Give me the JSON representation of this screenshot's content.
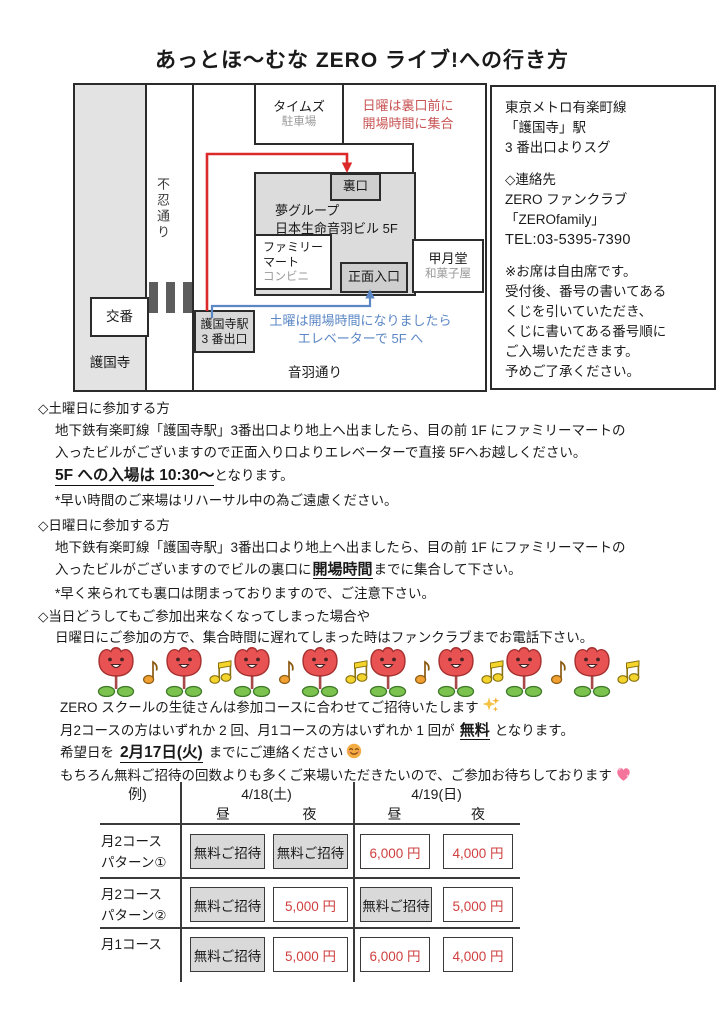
{
  "title": "あっとほ〜むな ZERO ライブ!への行き方",
  "map": {
    "road_shinobazu": "不忍通り",
    "road_otowa": "音羽通り",
    "gokokuji_label": "護国寺",
    "koban_label": "交番",
    "times_line1": "タイムズ",
    "times_line2": "駐車場",
    "sunday_note_line1": "日曜は裏口前に",
    "sunday_note_line2": "開場時間に集合",
    "back_door_label": "裏口",
    "building_line1": "夢グループ",
    "building_line2": "日本生命音羽ビル 5F",
    "familymart_line1": "ファミリー",
    "familymart_line2": "マート",
    "familymart_line3": "コンビニ",
    "front_entrance_label": "正面入口",
    "kogetsudo_line1": "甲月堂",
    "kogetsudo_line2": "和菓子屋",
    "station_line1": "護国寺駅",
    "station_line2": "3 番出口",
    "saturday_note_line1": "土曜は開場時間になりましたら",
    "saturday_note_line2": "エレベーターで 5F へ"
  },
  "info_panel": {
    "access_line1": "東京メトロ有楽町線",
    "access_line2": "「護国寺」駅",
    "access_line3": "3 番出口よりスグ",
    "contact_heading": "◇連絡先",
    "contact_line1": "ZERO ファンクラブ",
    "contact_line2": "「ZEROfamily」",
    "contact_tel": "TEL:03-5395-7390",
    "seating_line1": "※お席は自由席です。",
    "seating_line2": "受付後、番号の書いてある",
    "seating_line3": "くじを引いていただき、",
    "seating_line4": "くじに書いてある番号順に",
    "seating_line5": "ご入場いただきます。",
    "seating_line6": "予めご了承ください。"
  },
  "saturday_section": {
    "heading": "◇土曜日に参加する方",
    "line1": "地下鉄有楽町線「護国寺駅」3番出口より地上へ出ましたら、目の前 1F にファミリーマートの",
    "line2": "入ったビルがございますので正面入り口よりエレベーターで直接 5Fへお越しください。",
    "entry_highlight": "5F への入場は 10:30〜",
    "entry_suffix": "となります。",
    "note": "*早い時間のご来場はリハーサル中の為ご遠慮ください。"
  },
  "sunday_section": {
    "heading": "◇日曜日に参加する方",
    "line1": "地下鉄有楽町線「護国寺駅」3番出口より地上へ出ましたら、目の前 1F にファミリーマートの",
    "line2_pre": "入ったビルがございますのでビルの裏口に",
    "line2_highlight": "開場時間",
    "line2_post": "までに集合して下さい。",
    "note": "*早く来られても裏口は閉まっておりますので、ご注意下さい。"
  },
  "cancel_section": {
    "heading": "◇当日どうしてもご参加出来なくなってしまった場合や",
    "line1": "日曜日にご参加の方で、集合時間に遅れてしまった時はファンクラブまでお電話下さい。"
  },
  "invite_section": {
    "line1": "ZERO スクールの生徒さんは参加コースに合わせてご招待いたします",
    "line2_pre": "月2コースの方はいずれか 2 回、月1コースの方はいずれか 1 回が",
    "line2_highlight": "無料",
    "line2_post": "となります。",
    "line3_pre": "希望日を",
    "line3_highlight": "2月17日(火)",
    "line3_post": "までにご連絡ください",
    "line4": "もちろん無料ご招待の回数よりも多くご来場いただきたいので、ご参加お待ちしております"
  },
  "fee_table": {
    "corner_label": "例)",
    "date_headers": [
      "4/18(土)",
      "4/19(日)"
    ],
    "time_headers": [
      "昼",
      "夜",
      "昼",
      "夜"
    ],
    "rows": [
      {
        "label_line1": "月2コース",
        "label_line2": "パターン①",
        "cells": [
          {
            "text": "無料ご招待",
            "type": "free"
          },
          {
            "text": "無料ご招待",
            "type": "free"
          },
          {
            "text": "6,000 円",
            "type": "price"
          },
          {
            "text": "4,000 円",
            "type": "price"
          }
        ]
      },
      {
        "label_line1": "月2コース",
        "label_line2": "パターン②",
        "cells": [
          {
            "text": "無料ご招待",
            "type": "free"
          },
          {
            "text": "5,000 円",
            "type": "price"
          },
          {
            "text": "無料ご招待",
            "type": "free"
          },
          {
            "text": "5,000 円",
            "type": "price"
          }
        ]
      },
      {
        "label_line1": "月1コース",
        "label_line2": "",
        "cells": [
          {
            "text": "無料ご招待",
            "type": "free"
          },
          {
            "text": "5,000 円",
            "type": "price"
          },
          {
            "text": "6,000 円",
            "type": "price"
          },
          {
            "text": "4,000 円",
            "type": "price"
          }
        ]
      }
    ]
  },
  "decorations": {
    "tulip_icon": "tulip-face-icon",
    "note_icons": [
      "eighth-note-icon",
      "beamed-notes-icon"
    ],
    "sparkles_icon": "sparkles-icon",
    "smiley_icon": "smiling-face-icon",
    "heart_icon": "sparkling-heart-icon"
  },
  "colors": {
    "red_note_text": "#c85454",
    "blue_note_text": "#5b87c5",
    "price_red": "#cf4040",
    "free_cell_gray": "#d9d9d9",
    "map_gray": "#dcdcdc"
  }
}
